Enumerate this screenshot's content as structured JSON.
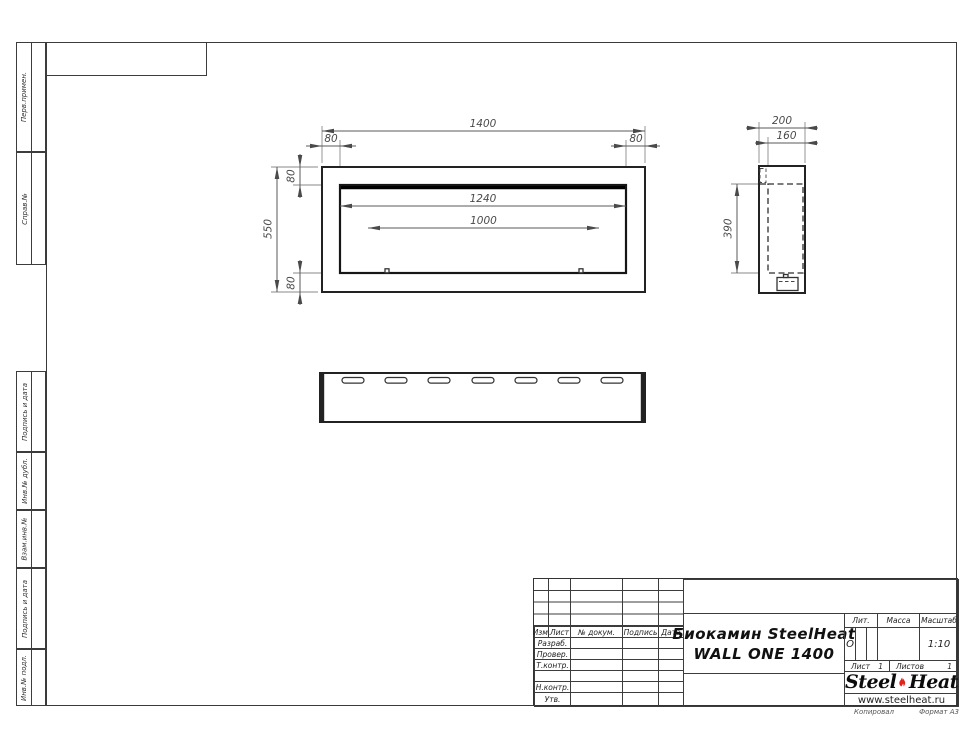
{
  "sheet": {
    "stamp_sidebar": {
      "labels": [
        "Перв.примен.",
        "Справ.№",
        "Подпись и дата",
        "Инв.№ дубл.",
        "Взам.инв.№",
        "Подпись и дата",
        "Инв.№ подл."
      ]
    },
    "views": {
      "front": {
        "dim_width": "1400",
        "dim_offset_left": "80",
        "dim_offset_right": "80",
        "dim_offset_top": "80",
        "dim_offset_bottom": "80",
        "dim_height": "550",
        "dim_inner_width": "1240",
        "dim_burner_width": "1000"
      },
      "side": {
        "dim_depth": "200",
        "dim_inner_depth": "160",
        "dim_inner_height": "390"
      }
    },
    "title_block": {
      "header": {
        "izm": "Изм.",
        "list": "Лист",
        "doc": "№ докум.",
        "sign": "Подпись",
        "date": "Дата"
      },
      "rows": [
        "Разраб.",
        "Провер.",
        "Т.контр.",
        "",
        "Н.контр.",
        "Утв."
      ],
      "title_line1": "Биокамин SteelHeat",
      "title_line2": "WALL ONE 1400",
      "lit_label": "Лит.",
      "lit_value": "О",
      "mass_label": "Масса",
      "scale_label": "Масштаб",
      "scale_value": "1:10",
      "sheet_label": "Лист",
      "sheet_value": "1",
      "sheets_label": "Листов",
      "sheets_value": "1",
      "logo": {
        "steel": "Steel",
        "heat": "Heat",
        "url": "www.steelheat.ru"
      }
    },
    "footer": {
      "copy": "Копировал",
      "format": "Формат А3"
    }
  }
}
